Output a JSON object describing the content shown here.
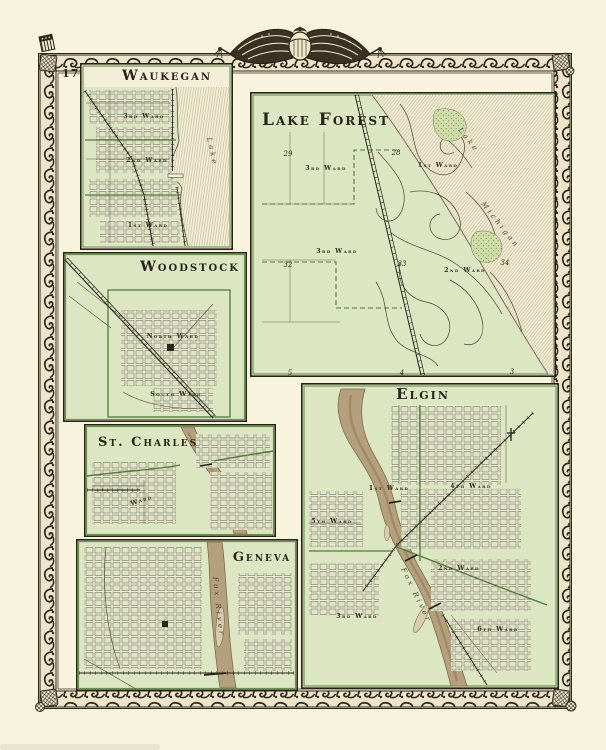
{
  "page": {
    "number": "17"
  },
  "colors": {
    "paper": "#f7f3dc",
    "map_green": "#dce6c3",
    "boundary_green": "#4f7d35",
    "ink": "#2b261d",
    "frame_ink": "#2d2619",
    "river_tan": "#b5a07e",
    "lake_cream": "#f4efd8"
  },
  "ornament": {
    "name": "draped-flags-with-crest"
  },
  "panels": {
    "waukegan": {
      "title": "Waukegan",
      "wards": [
        "3rd Ward",
        "2nd Ward",
        "1st Ward"
      ],
      "water": "Lake"
    },
    "lake_forest": {
      "title": "Lake Forest",
      "wards": [
        "3rd Ward",
        "1st Ward",
        "3rd Ward",
        "2nd Ward"
      ],
      "water_line1": "Lake",
      "water_line2": "Michigan",
      "sections": [
        "29",
        "28",
        "32",
        "33",
        "34",
        "5",
        "4",
        "3"
      ]
    },
    "woodstock": {
      "title": "Woodstock",
      "wards": [
        "North Ward",
        "South Ward"
      ]
    },
    "st_charles": {
      "title": "St. Charles",
      "ward": "Ward"
    },
    "geneva": {
      "title": "Geneva",
      "water": "Fox River"
    },
    "elgin": {
      "title": "Elgin",
      "wards": [
        "1st Ward",
        "4th Ward",
        "5th Ward",
        "2nd Ward",
        "3rd Ward",
        "6th Ward"
      ],
      "water": "Fox River"
    }
  }
}
